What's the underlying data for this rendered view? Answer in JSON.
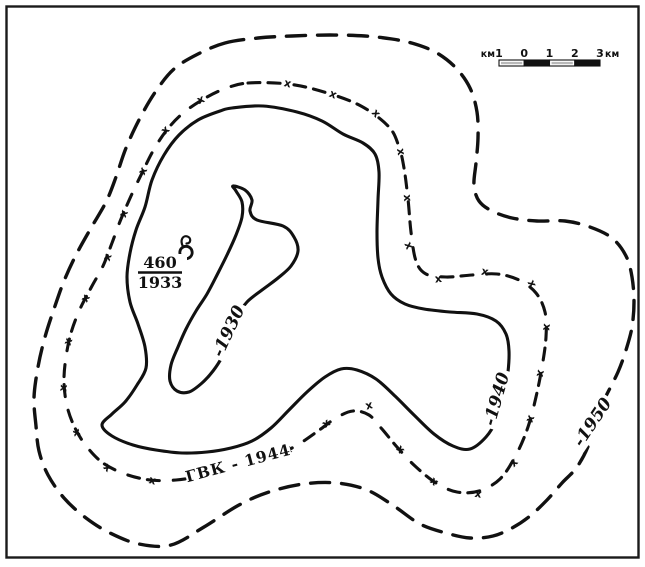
{
  "map": {
    "well": {
      "number": "460",
      "year": "1933"
    },
    "contour_labels": {
      "inner": "-1930",
      "middle": "-1940",
      "gwc": "ГВК - 1944",
      "outer": "-1950"
    },
    "gwc_tick_string": "xxxxxxxxxxxxxxxxxxxxxxxxxxxxxxxxxx",
    "scale_bar": {
      "unit_left": "км",
      "tick_labels": [
        "1",
        "0",
        "1",
        "2",
        "3"
      ],
      "unit_right": "км"
    },
    "colors": {
      "ink": "#111111",
      "paper": "#ffffff",
      "scale_light_fill": "#b9b9b9"
    }
  }
}
